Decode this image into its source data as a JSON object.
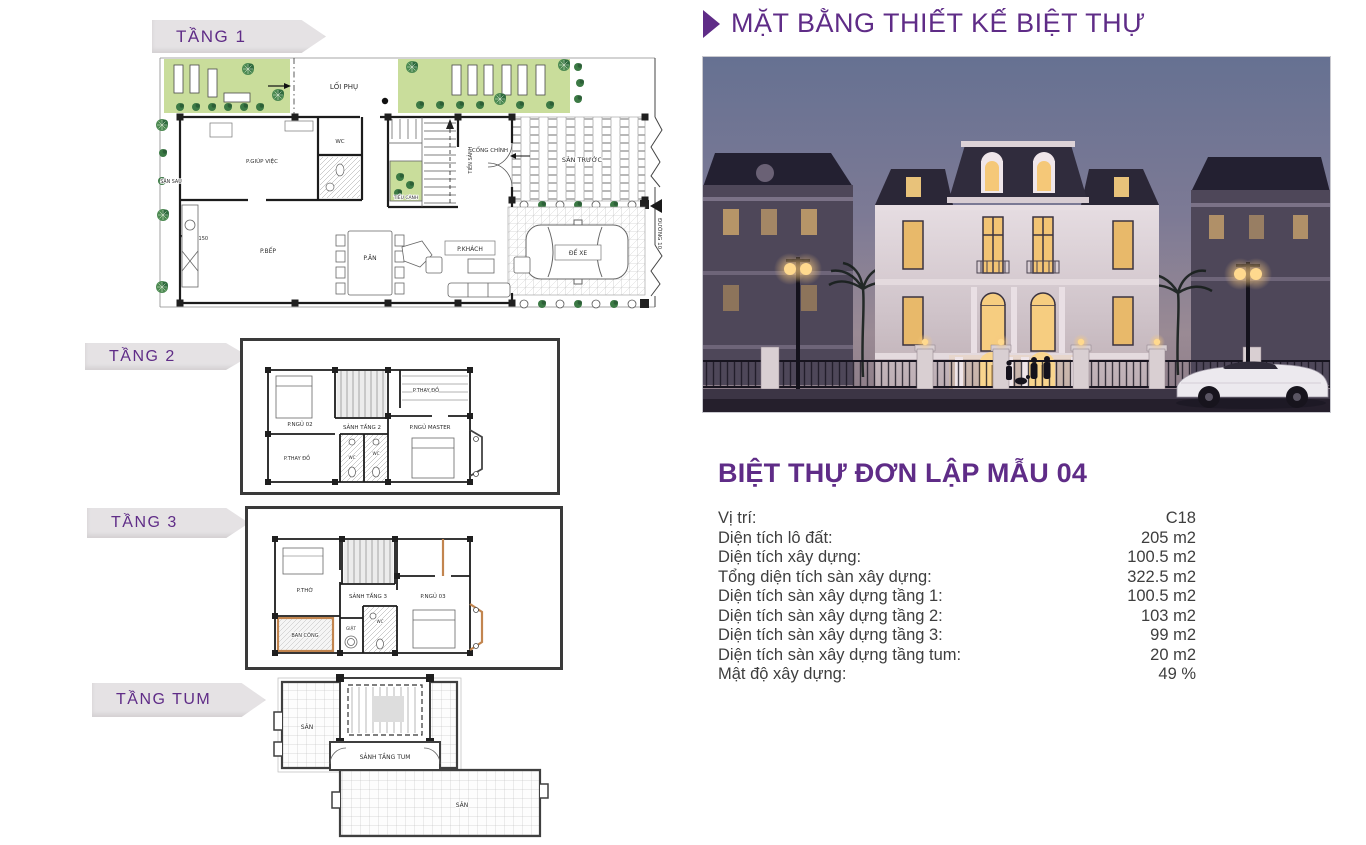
{
  "header": {
    "title": "MẶT BẰNG THIẾT KẾ BIỆT THỰ"
  },
  "plans": {
    "tang1": {
      "banner": "TẦNG 1",
      "labels": {
        "loi_phu": "LỐI PHỤ",
        "san_sau": "SÂN SAU",
        "p_giup_viec": "P.GIÚP VIỆC",
        "wc": "WC",
        "tieu_canh": "TIỂU CẢNH",
        "tien_sanh": "TIỀN SẢNH",
        "cong_chinh": "CỔNG CHÍNH",
        "san_truoc": "SÂN TRƯỚC",
        "p_bep": "P.BẾP",
        "p_an": "P.ĂN",
        "p_khach": "P.KHÁCH",
        "de_xe": "ĐỂ XE",
        "level": "-0.150",
        "duong10": "ĐƯỜNG 10"
      }
    },
    "tang2": {
      "banner": "TẦNG 2",
      "labels": {
        "p_ngu_02": "P.NGỦ 02",
        "p_thay_do_trai": "P.THAY ĐỒ",
        "sanh_tang_2": "SẢNH TẦNG 2",
        "p_thay_do_phai": "P.THAY ĐỒ",
        "p_ngu_master": "P.NGỦ MASTER",
        "wc1": "WC",
        "wc2": "WC"
      }
    },
    "tang3": {
      "banner": "TẦNG 3",
      "labels": {
        "p_tho": "P.THỜ",
        "sanh_tang_3": "SẢNH TẦNG 3",
        "p_ngu_03": "P.NGỦ 03",
        "ban_cong": "BAN CÔNG",
        "giat": "GIẶT",
        "wc": "WC"
      }
    },
    "tangtum": {
      "banner": "TẦNG TUM",
      "labels": {
        "san_trai": "SÂN",
        "sanh_tang_tum": "SẢNH TẦNG TUM",
        "san_phai": "SÂN"
      }
    }
  },
  "info": {
    "title": "BIỆT THỰ ĐƠN LẬP MẪU 04",
    "rows": [
      {
        "label": "Vị trí:",
        "value": "C18"
      },
      {
        "label": "Diện tích lô đất:",
        "value": "205 m2"
      },
      {
        "label": "Diện tích xây dựng:",
        "value": "100.5 m2"
      },
      {
        "label": "Tổng diện tích sàn xây dựng:",
        "value": "322.5 m2"
      },
      {
        "label": "Diện tích sàn xây dựng tầng 1:",
        "value": "100.5 m2"
      },
      {
        "label": "Diện tích sàn xây dựng tầng 2:",
        "value": "103 m2"
      },
      {
        "label": "Diện tích sàn xây dựng tầng 3:",
        "value": "99 m2"
      },
      {
        "label": "Diện tích sàn xây dựng tầng tum:",
        "value": "20 m2"
      },
      {
        "label": "Mật độ xây dựng:",
        "value": "49 %"
      }
    ]
  },
  "colors": {
    "accent_purple": "#5f2c87",
    "banner_gray": "#e5e2e4",
    "plan_green": "#c9dd9b",
    "text_dark": "#3e3e3e",
    "photo_sky": "#677192",
    "photo_roof": "#2c2836",
    "photo_window_glow": "#f5c878"
  }
}
